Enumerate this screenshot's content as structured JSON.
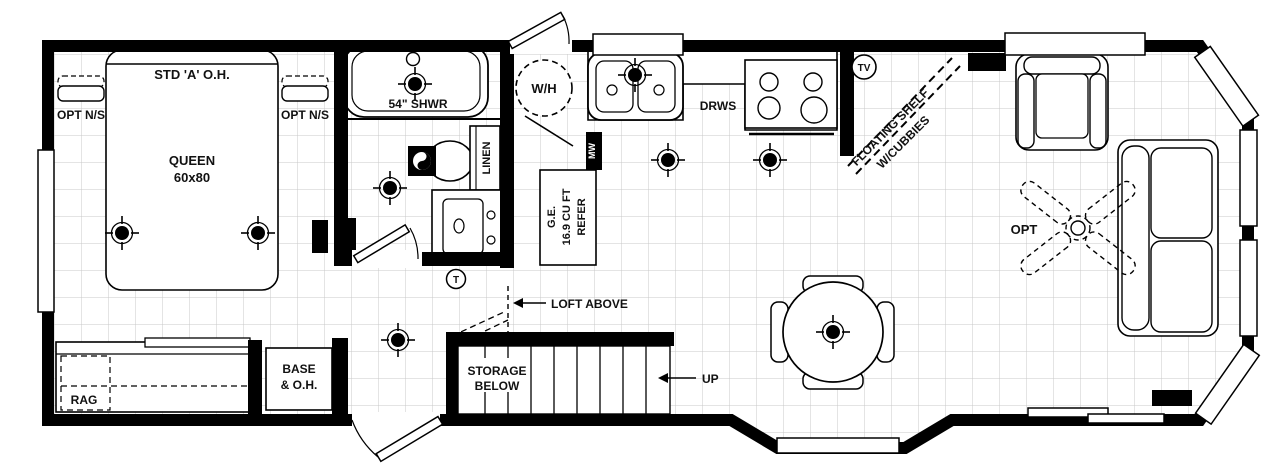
{
  "labels": {
    "bedroom": {
      "overhead_cabinet": "STD 'A' O.H.",
      "nightstand_left": "OPT N/S",
      "nightstand_right": "OPT N/S",
      "bed_type": "QUEEN",
      "bed_size": "60x80",
      "rag": "RAG",
      "base_line1": "BASE",
      "base_line2": "& O.H."
    },
    "bathroom": {
      "shower": "54\" SHWR",
      "linen": "LINEN"
    },
    "kitchen": {
      "water_heater": "W/H",
      "fridge_line1": "G.E.",
      "fridge_line2": "16.9 CU FT",
      "fridge_line3": "REFER",
      "microwave": "MW",
      "drawers": "DRWS"
    },
    "living_room": {
      "floating_shelf_line1": "FLOATING SHELF",
      "floating_shelf_line2": "W/CUBBIES",
      "ceiling_fan": "OPT"
    },
    "stairs": {
      "storage_line1": "STORAGE",
      "storage_line2": "BELOW",
      "up": "UP",
      "loft": "LOFT ABOVE"
    },
    "symbols": {
      "thermostat": "T",
      "tv_jack": "TV"
    }
  },
  "colors": {
    "wall": "#000000",
    "grid": "#c9c9c9",
    "background": "#ffffff"
  }
}
